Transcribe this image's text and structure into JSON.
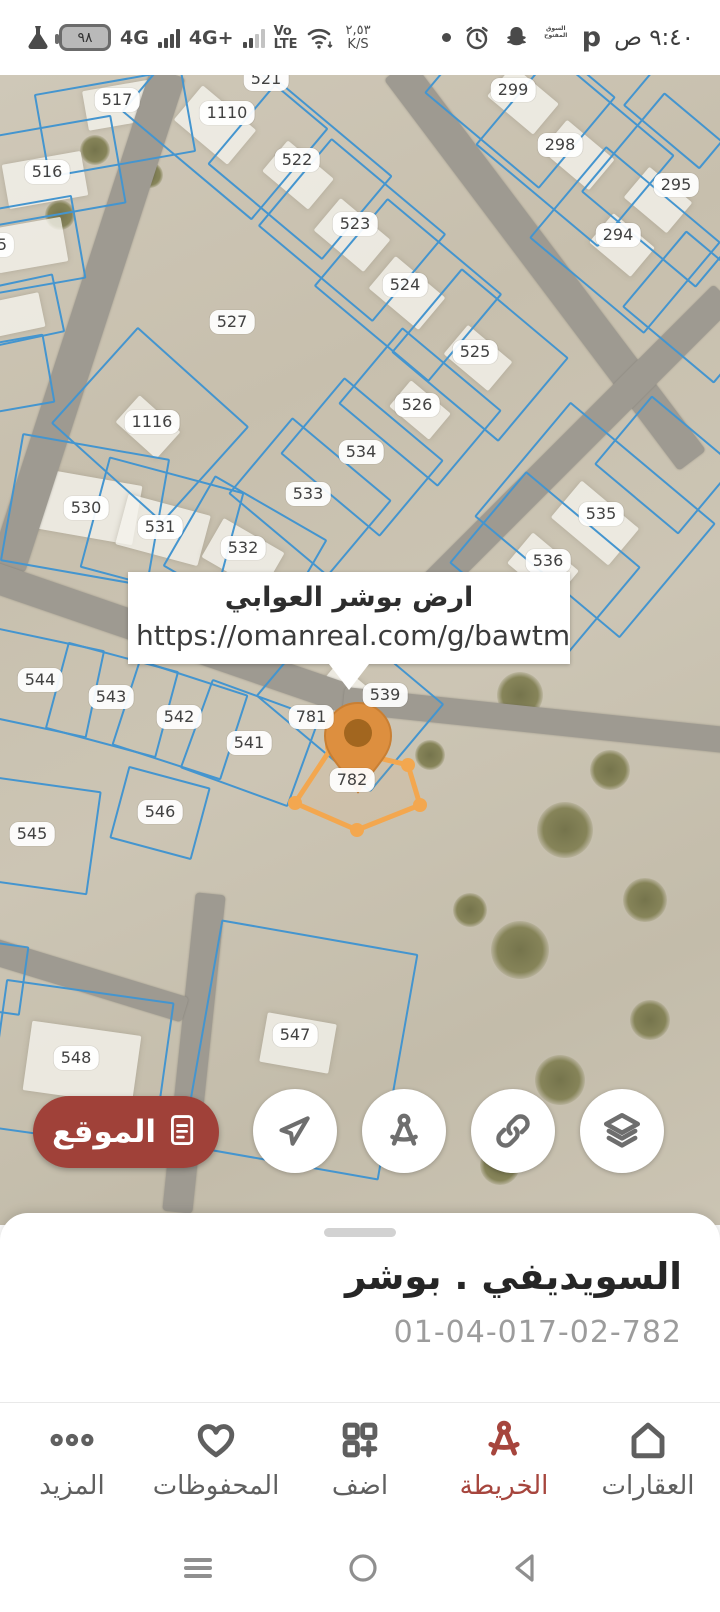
{
  "status_bar": {
    "battery_level": "٩٨",
    "net_primary": "4G",
    "net_secondary": "4G+",
    "volte": "Vo\nLTE",
    "speed": "٢,٥٣\nK/S",
    "time": "٩:٤٠ ص"
  },
  "map": {
    "callout": {
      "title": "ارض بوشر العوابي",
      "url": "https://omanreal.com/g/bawtm"
    },
    "selected_parcel": "782",
    "colors": {
      "parcel_line": "#4495cf",
      "selection_orange": "#f3a74f",
      "pin_fill": "#dd8f3f",
      "pin_core": "#a2661f",
      "road": "#9e9a91"
    },
    "labels": [
      {
        "text": "517",
        "x": 117,
        "y": 25
      },
      {
        "text": "516",
        "x": 47,
        "y": 97
      },
      {
        "text": "5",
        "x": 2,
        "y": 170
      },
      {
        "text": "521",
        "x": 266,
        "y": 4
      },
      {
        "text": "1110",
        "x": 227,
        "y": 38
      },
      {
        "text": "522",
        "x": 297,
        "y": 85
      },
      {
        "text": "523",
        "x": 355,
        "y": 149
      },
      {
        "text": "524",
        "x": 405,
        "y": 210
      },
      {
        "text": "527",
        "x": 232,
        "y": 247
      },
      {
        "text": "299",
        "x": 513,
        "y": 15
      },
      {
        "text": "298",
        "x": 560,
        "y": 70
      },
      {
        "text": "295",
        "x": 676,
        "y": 110
      },
      {
        "text": "294",
        "x": 618,
        "y": 160
      },
      {
        "text": "525",
        "x": 475,
        "y": 277
      },
      {
        "text": "526",
        "x": 417,
        "y": 330
      },
      {
        "text": "534",
        "x": 361,
        "y": 377
      },
      {
        "text": "1116",
        "x": 152,
        "y": 347
      },
      {
        "text": "530",
        "x": 86,
        "y": 433
      },
      {
        "text": "531",
        "x": 160,
        "y": 452
      },
      {
        "text": "532",
        "x": 243,
        "y": 473
      },
      {
        "text": "533",
        "x": 308,
        "y": 419
      },
      {
        "text": "535",
        "x": 601,
        "y": 439
      },
      {
        "text": "536",
        "x": 548,
        "y": 486
      },
      {
        "text": "544",
        "x": 40,
        "y": 605
      },
      {
        "text": "543",
        "x": 111,
        "y": 622
      },
      {
        "text": "542",
        "x": 179,
        "y": 642
      },
      {
        "text": "541",
        "x": 249,
        "y": 668
      },
      {
        "text": "539",
        "x": 385,
        "y": 620
      },
      {
        "text": "781",
        "x": 311,
        "y": 642
      },
      {
        "text": "782",
        "x": 352,
        "y": 705
      },
      {
        "text": "546",
        "x": 160,
        "y": 737
      },
      {
        "text": "545",
        "x": 32,
        "y": 759
      },
      {
        "text": "547",
        "x": 295,
        "y": 960
      },
      {
        "text": "548",
        "x": 76,
        "y": 983
      }
    ],
    "roads": [
      {
        "x": 88,
        "y": 245,
        "w": 520,
        "h": 36,
        "rot": 108
      },
      {
        "x": 545,
        "y": 190,
        "w": 490,
        "h": 34,
        "rot": 53
      },
      {
        "x": 572,
        "y": 372,
        "w": 430,
        "h": 30,
        "rot": 135
      },
      {
        "x": 167,
        "y": 562,
        "w": 380,
        "h": 30,
        "rot": 19
      },
      {
        "x": 535,
        "y": 645,
        "w": 385,
        "h": 26,
        "rot": 6
      },
      {
        "x": 194,
        "y": 978,
        "w": 320,
        "h": 30,
        "rot": 96
      },
      {
        "x": 87,
        "y": 905,
        "w": 205,
        "h": 26,
        "rot": 17
      }
    ],
    "parcels": [
      {
        "x": 115,
        "y": 48,
        "w": 150,
        "h": 85,
        "rot": -10
      },
      {
        "x": 45,
        "y": 97,
        "w": 150,
        "h": 90,
        "rot": -10
      },
      {
        "x": 20,
        "y": 172,
        "w": 120,
        "h": 85,
        "rot": -10
      },
      {
        "x": 15,
        "y": 237,
        "w": 90,
        "h": 60,
        "rot": -12
      },
      {
        "x": 10,
        "y": 300,
        "w": 80,
        "h": 70,
        "rot": -10
      },
      {
        "x": 225,
        "y": 45,
        "w": 170,
        "h": 120,
        "rot": 40
      },
      {
        "x": 300,
        "y": 95,
        "w": 150,
        "h": 110,
        "rot": 40
      },
      {
        "x": 352,
        "y": 155,
        "w": 150,
        "h": 115,
        "rot": 40
      },
      {
        "x": 408,
        "y": 215,
        "w": 150,
        "h": 115,
        "rot": 40
      },
      {
        "x": 480,
        "y": 280,
        "w": 140,
        "h": 110,
        "rot": 40
      },
      {
        "x": 420,
        "y": 332,
        "w": 130,
        "h": 100,
        "rot": 40
      },
      {
        "x": 362,
        "y": 382,
        "w": 130,
        "h": 100,
        "rot": 40
      },
      {
        "x": 520,
        "y": 20,
        "w": 150,
        "h": 120,
        "rot": 40
      },
      {
        "x": 575,
        "y": 75,
        "w": 160,
        "h": 120,
        "rot": 40
      },
      {
        "x": 680,
        "y": 115,
        "w": 150,
        "h": 130,
        "rot": 40
      },
      {
        "x": 625,
        "y": 165,
        "w": 150,
        "h": 120,
        "rot": 40
      },
      {
        "x": 700,
        "y": 232,
        "w": 120,
        "h": 100,
        "rot": 40
      },
      {
        "x": 690,
        "y": 28,
        "w": 100,
        "h": 90,
        "rot": 40
      },
      {
        "x": 595,
        "y": 445,
        "w": 190,
        "h": 150,
        "rot": 40
      },
      {
        "x": 545,
        "y": 490,
        "w": 150,
        "h": 120,
        "rot": 40
      },
      {
        "x": 665,
        "y": 390,
        "w": 110,
        "h": 90,
        "rot": 40
      },
      {
        "x": 150,
        "y": 350,
        "w": 150,
        "h": 130,
        "rot": 42
      },
      {
        "x": 85,
        "y": 435,
        "w": 150,
        "h": 130,
        "rot": 10
      },
      {
        "x": 162,
        "y": 455,
        "w": 140,
        "h": 115,
        "rot": 15
      },
      {
        "x": 245,
        "y": 478,
        "w": 130,
        "h": 105,
        "rot": 30
      },
      {
        "x": 310,
        "y": 422,
        "w": 130,
        "h": 100,
        "rot": 40
      },
      {
        "x": 42,
        "y": 608,
        "w": 110,
        "h": 90,
        "rot": 12
      },
      {
        "x": 112,
        "y": 625,
        "w": 115,
        "h": 90,
        "rot": 15
      },
      {
        "x": 180,
        "y": 645,
        "w": 115,
        "h": 90,
        "rot": 18
      },
      {
        "x": 250,
        "y": 668,
        "w": 115,
        "h": 95,
        "rot": 20
      },
      {
        "x": 350,
        "y": 625,
        "w": 150,
        "h": 115,
        "rot": 40
      },
      {
        "x": 160,
        "y": 738,
        "w": 85,
        "h": 75,
        "rot": 15
      },
      {
        "x": 35,
        "y": 760,
        "w": 120,
        "h": 105,
        "rot": 8
      },
      {
        "x": 300,
        "y": 975,
        "w": 200,
        "h": 230,
        "rot": 10
      },
      {
        "x": 80,
        "y": 990,
        "w": 170,
        "h": 150,
        "rot": 8
      },
      {
        "x": -20,
        "y": 900,
        "w": 90,
        "h": 70,
        "rot": 8
      }
    ],
    "buildings": [
      {
        "x": 120,
        "y": 30,
        "w": 70,
        "h": 40,
        "rot": -10
      },
      {
        "x": 45,
        "y": 105,
        "w": 80,
        "h": 45,
        "rot": -10
      },
      {
        "x": 30,
        "y": 170,
        "w": 70,
        "h": 45,
        "rot": -10
      },
      {
        "x": 15,
        "y": 240,
        "w": 55,
        "h": 35,
        "rot": -12
      },
      {
        "x": 215,
        "y": 50,
        "w": 70,
        "h": 45,
        "rot": 40
      },
      {
        "x": 298,
        "y": 100,
        "w": 60,
        "h": 40,
        "rot": 40
      },
      {
        "x": 352,
        "y": 160,
        "w": 65,
        "h": 42,
        "rot": 40
      },
      {
        "x": 407,
        "y": 218,
        "w": 65,
        "h": 42,
        "rot": 40
      },
      {
        "x": 478,
        "y": 283,
        "w": 58,
        "h": 38,
        "rot": 40
      },
      {
        "x": 420,
        "y": 335,
        "w": 52,
        "h": 34,
        "rot": 40
      },
      {
        "x": 523,
        "y": 25,
        "w": 60,
        "h": 40,
        "rot": 40
      },
      {
        "x": 578,
        "y": 80,
        "w": 62,
        "h": 40,
        "rot": 40
      },
      {
        "x": 658,
        "y": 125,
        "w": 56,
        "h": 40,
        "rot": 40
      },
      {
        "x": 622,
        "y": 170,
        "w": 54,
        "h": 38,
        "rot": 40
      },
      {
        "x": 88,
        "y": 432,
        "w": 100,
        "h": 60,
        "rot": 10
      },
      {
        "x": 163,
        "y": 455,
        "w": 85,
        "h": 52,
        "rot": 15
      },
      {
        "x": 243,
        "y": 480,
        "w": 70,
        "h": 45,
        "rot": 30
      },
      {
        "x": 148,
        "y": 352,
        "w": 55,
        "h": 36,
        "rot": 42
      },
      {
        "x": 595,
        "y": 448,
        "w": 75,
        "h": 48,
        "rot": 40
      },
      {
        "x": 543,
        "y": 492,
        "w": 60,
        "h": 40,
        "rot": 40
      },
      {
        "x": 348,
        "y": 622,
        "w": 60,
        "h": 40,
        "rot": 40
      },
      {
        "x": 82,
        "y": 988,
        "w": 110,
        "h": 70,
        "rot": 8
      },
      {
        "x": 298,
        "y": 968,
        "w": 70,
        "h": 50,
        "rot": 10
      }
    ],
    "bushes": [
      {
        "x": 95,
        "y": 75,
        "w": 30,
        "h": 30
      },
      {
        "x": 150,
        "y": 100,
        "w": 26,
        "h": 26
      },
      {
        "x": 60,
        "y": 140,
        "w": 30,
        "h": 30
      },
      {
        "x": 520,
        "y": 620,
        "w": 46,
        "h": 46
      },
      {
        "x": 610,
        "y": 695,
        "w": 40,
        "h": 40
      },
      {
        "x": 565,
        "y": 755,
        "w": 56,
        "h": 56
      },
      {
        "x": 645,
        "y": 825,
        "w": 44,
        "h": 44
      },
      {
        "x": 520,
        "y": 875,
        "w": 58,
        "h": 58
      },
      {
        "x": 650,
        "y": 945,
        "w": 40,
        "h": 40
      },
      {
        "x": 560,
        "y": 1005,
        "w": 50,
        "h": 50
      },
      {
        "x": 470,
        "y": 835,
        "w": 34,
        "h": 34
      },
      {
        "x": 430,
        "y": 680,
        "w": 30,
        "h": 30
      },
      {
        "x": 610,
        "y": 1060,
        "w": 46,
        "h": 46
      },
      {
        "x": 500,
        "y": 1090,
        "w": 40,
        "h": 40
      }
    ]
  },
  "fab": {
    "location_label": "الموقع"
  },
  "bottom_sheet": {
    "title": "السويديفي . بوشر",
    "code": "01-04-017-02-782"
  },
  "bottom_nav": {
    "items": [
      {
        "label": "العقارات",
        "active": false
      },
      {
        "label": "الخريطة",
        "active": true
      },
      {
        "label": "اضف",
        "active": false
      },
      {
        "label": "المحفوظات",
        "active": false
      },
      {
        "label": "المزيد",
        "active": false
      }
    ]
  },
  "status_icons": {
    "opensooq_text": "السوق المفتوح",
    "p_label": "p"
  }
}
